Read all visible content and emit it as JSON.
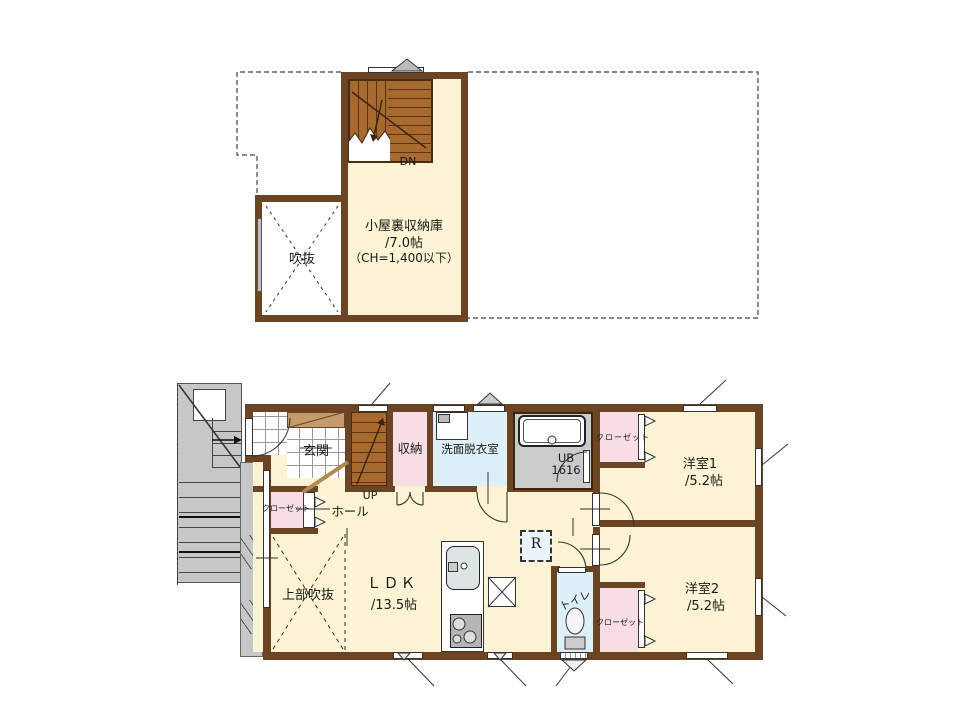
{
  "title": "2-story house floor plan",
  "colors": {
    "wall": "#6b4423",
    "floor_cream": "#fbf3d3",
    "closet_pink": "#f8dee2",
    "wet_area_blue": "#def0f7",
    "bath_gray": "#cbcbcb",
    "stair_wood": "#a8692f",
    "exterior_gray": "#c7c7c7"
  },
  "floors": {
    "attic": {
      "stairs_label": "DN",
      "room_name": "小屋裏収納庫",
      "room_size": "/7.0帖",
      "room_note": "（CH=1,400以下）",
      "void_label": "吹抜"
    },
    "first": {
      "entrance": "玄関",
      "stairs_label": "UP",
      "hall": "ホール",
      "storage": "収納",
      "washroom": "洗面脱衣室",
      "bath_name": "UB",
      "bath_size": "1616",
      "closet": "クローゼット",
      "bedroom1_name": "洋室1",
      "bedroom1_size": "/5.2帖",
      "bedroom2_name": "洋室2",
      "bedroom2_size": "/5.2帖",
      "ldk_name": "ＬＤＫ",
      "ldk_size": "/13.5帖",
      "void_above": "上部吹抜",
      "toilet": "トイレ",
      "refrigerator": "R"
    }
  }
}
